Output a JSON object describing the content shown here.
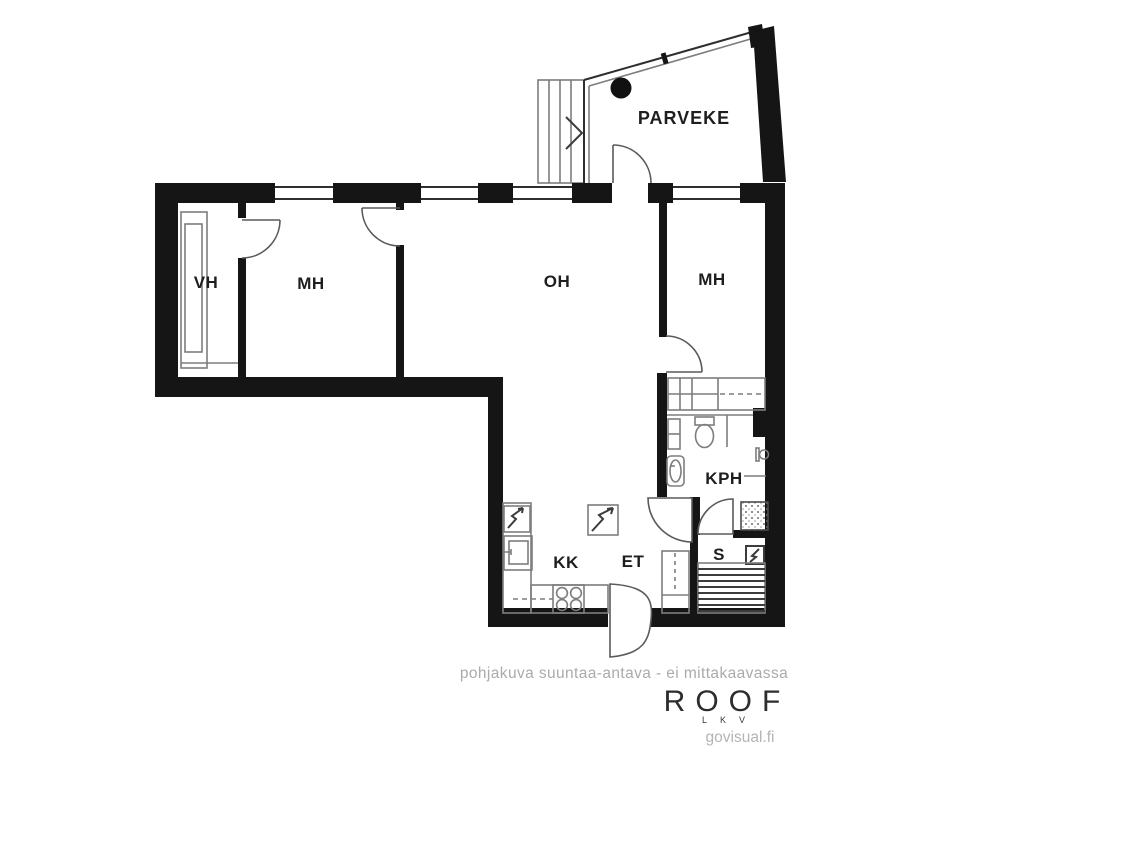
{
  "floorplan": {
    "labels": {
      "parveke": "PARVEKE",
      "vh": "VH",
      "mh_left": "MH",
      "oh": "OH",
      "mh_right": "MH",
      "kph": "KPH",
      "kk": "KK",
      "et": "ET",
      "s": "S"
    },
    "icons": {
      "stairs": "stairs-icon",
      "balcony_column": "column-dot",
      "fridge": "square-with-lightning",
      "kitchen_sink": "sink-basin",
      "stove": "four-burner-stove",
      "electrical_panel": "square-with-lightning",
      "toilet": "toilet-bowl",
      "washbasin": "oval-basin",
      "shower_area": "dotted-square",
      "sauna_heater": "square-with-lightning",
      "sauna_benches": "horizontal-slats",
      "wardrobe": "divided-rectangle-with-dashed-rail"
    },
    "colors": {
      "wall": "#151515",
      "fixture_line": "#7d7d7d",
      "label_text": "#1e1e1e",
      "muted_text": "#ababab",
      "brand_text": "#2d2d2d",
      "website_text": "#b4b4b4",
      "background": "#ffffff"
    }
  },
  "footer": {
    "disclaimer": "pohjakuva suuntaa-antava - ei mittakaavassa",
    "brand": "ROOF",
    "brand_sub": "LKV",
    "website": "govisual.fi"
  }
}
